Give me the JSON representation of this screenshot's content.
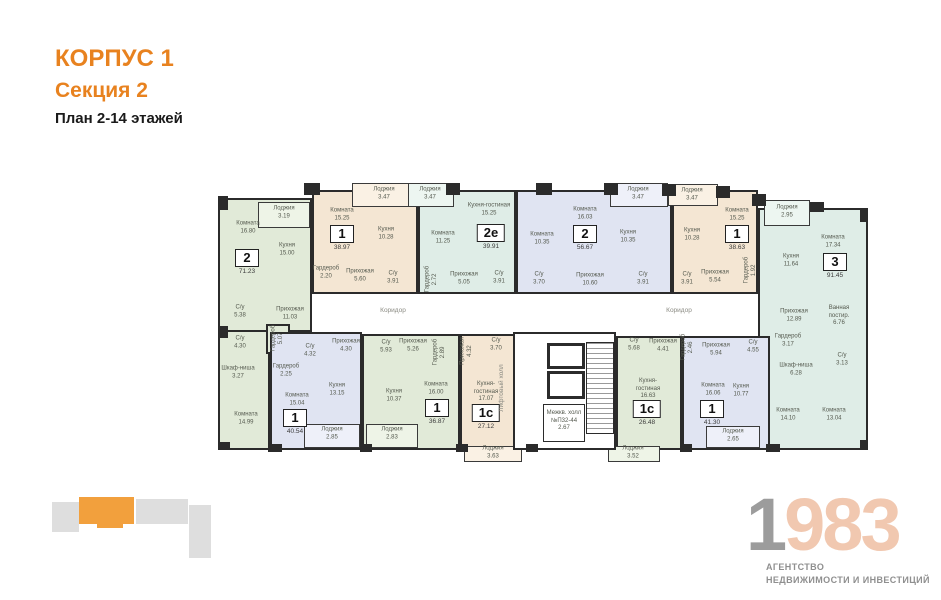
{
  "header": {
    "building": "КОРПУС 1",
    "section": "Секция 2",
    "plan": "План 2-14 этажей"
  },
  "palette": {
    "accent_orange": "#E8821F",
    "wall": "#2B2B2B",
    "apt_green": "#E1EAD8",
    "apt_beige": "#F4E6D3",
    "apt_mint": "#DFEDE7",
    "apt_blue": "#E0E4F2",
    "logo_gray": "#9C9C9C",
    "logo_peach": "#F1C8B0",
    "mini_gray": "#DEDEDE",
    "mini_orange": "#F2A03D"
  },
  "apartments": [
    {
      "badge": {
        "type": "2",
        "area": "71.23"
      },
      "rooms": [
        {
          "name": "Лоджия",
          "area": "3.19"
        },
        {
          "name": "Комната",
          "area": "16.80"
        },
        {
          "name": "Кухня",
          "area": "15.00"
        },
        {
          "name": "Прихожая",
          "area": "11.03"
        },
        {
          "name": "С/у",
          "area": "5.38"
        },
        {
          "name": "С/у",
          "area": "4.30"
        },
        {
          "name": "Гардероб",
          "area": "5.07"
        },
        {
          "name": "Шкаф-ниша",
          "area": "3.27"
        },
        {
          "name": "Комната",
          "area": "14.99"
        }
      ]
    },
    {
      "badge": {
        "type": "1",
        "area": "38.97"
      },
      "rooms": [
        {
          "name": "Лоджия",
          "area": "3.47"
        },
        {
          "name": "Комната",
          "area": "15.25"
        },
        {
          "name": "Кухня",
          "area": "10.28"
        },
        {
          "name": "Гардероб",
          "area": "2.20"
        },
        {
          "name": "Прихожая",
          "area": "5.60"
        },
        {
          "name": "С/у",
          "area": "3.91"
        }
      ]
    },
    {
      "badge": {
        "type": "2е",
        "area": "39.91"
      },
      "rooms": [
        {
          "name": "Лоджия",
          "area": "3.47"
        },
        {
          "name": "Кухня-гостиная",
          "area": "15.25"
        },
        {
          "name": "Комната",
          "area": "11.25"
        },
        {
          "name": "Гардероб",
          "area": "2.72"
        },
        {
          "name": "Прихожая",
          "area": "5.05"
        },
        {
          "name": "С/у",
          "area": "3.91"
        }
      ]
    },
    {
      "badge": {
        "type": "2",
        "area": "56.67"
      },
      "rooms": [
        {
          "name": "Лоджия",
          "area": "3.47"
        },
        {
          "name": "Комната",
          "area": "16.03"
        },
        {
          "name": "Комната",
          "area": "10.35"
        },
        {
          "name": "Кухня",
          "area": "10.35"
        },
        {
          "name": "Прихожая",
          "area": "10.60"
        },
        {
          "name": "С/у",
          "area": "3.70"
        },
        {
          "name": "С/у",
          "area": "3.91"
        }
      ]
    },
    {
      "badge": {
        "type": "1",
        "area": "38.63"
      },
      "rooms": [
        {
          "name": "Лоджия",
          "area": "3.47"
        },
        {
          "name": "Комната",
          "area": "15.25"
        },
        {
          "name": "Кухня",
          "area": "10.28"
        },
        {
          "name": "Прихожая",
          "area": "5.54"
        },
        {
          "name": "С/у",
          "area": "3.91"
        },
        {
          "name": "Гардероб",
          "area": "1.92"
        }
      ]
    },
    {
      "badge": {
        "type": "3",
        "area": "91.45"
      },
      "rooms": [
        {
          "name": "Лоджия",
          "area": "2.95"
        },
        {
          "name": "Комната",
          "area": "17.34"
        },
        {
          "name": "Кухня",
          "area": "11.64"
        },
        {
          "name": "Прихожая",
          "area": "12.89"
        },
        {
          "name": "Ванная постир.",
          "area": "6.76"
        },
        {
          "name": "Гардероб",
          "area": "3.17"
        },
        {
          "name": "Шкаф-ниша",
          "area": "6.28"
        },
        {
          "name": "С/у",
          "area": "3.13"
        },
        {
          "name": "Комната",
          "area": "14.10"
        },
        {
          "name": "Комната",
          "area": "13.04"
        }
      ]
    },
    {
      "badge": {
        "type": "1",
        "area": "40.54"
      },
      "rooms": [
        {
          "name": "Прихожая",
          "area": "4.30"
        },
        {
          "name": "С/у",
          "area": "4.32"
        },
        {
          "name": "Гардероб",
          "area": "2.25"
        },
        {
          "name": "Комната",
          "area": "15.04"
        },
        {
          "name": "Кухня",
          "area": "13.15"
        },
        {
          "name": "Лоджия",
          "area": "2.85"
        }
      ]
    },
    {
      "badge": {
        "type": "1",
        "area": "36.87"
      },
      "rooms": [
        {
          "name": "С/у",
          "area": "5.93"
        },
        {
          "name": "Прихожая",
          "area": "5.26"
        },
        {
          "name": "Гардероб",
          "area": "2.89"
        },
        {
          "name": "Кухня",
          "area": "10.37"
        },
        {
          "name": "Комната",
          "area": "16.00"
        },
        {
          "name": "Лоджия",
          "area": "2.83"
        }
      ]
    },
    {
      "badge": {
        "type": "1с",
        "area": "27.12"
      },
      "rooms": [
        {
          "name": "Прихожая",
          "area": "4.32"
        },
        {
          "name": "С/у",
          "area": "3.70"
        },
        {
          "name": "Кухня-гостиная",
          "area": "17.07"
        },
        {
          "name": "Лоджия",
          "area": "3.63"
        }
      ]
    },
    {
      "badge": {
        "type": "1с",
        "area": "26.48"
      },
      "rooms": [
        {
          "name": "С/у",
          "area": "5.68"
        },
        {
          "name": "Прихожая",
          "area": "4.41"
        },
        {
          "name": "Кухня-гостиная",
          "area": "16.63"
        },
        {
          "name": "Лоджия",
          "area": "3.52"
        }
      ]
    },
    {
      "badge": {
        "type": "1",
        "area": "41.30"
      },
      "rooms": [
        {
          "name": "Гардероб",
          "area": "2.46"
        },
        {
          "name": "Прихожая",
          "area": "5.94"
        },
        {
          "name": "С/у",
          "area": "4.55"
        },
        {
          "name": "Комната",
          "area": "16.06"
        },
        {
          "name": "Кухня",
          "area": "10.77"
        },
        {
          "name": "Лоджия",
          "area": "2.65"
        }
      ]
    }
  ],
  "core": {
    "corridor_left": "Коридор",
    "corridor_right": "Коридор",
    "lift_hall": "Лифтовый холл",
    "inter_hall_name": "Межкв. холл",
    "inter_hall_num": "№П32-44",
    "inter_hall_area": "2.67"
  },
  "logo": {
    "digit_first": "1",
    "digits_rest": "983",
    "caption1": "АГЕНТСТВО",
    "caption2": "НЕДВИЖИМОСТИ И ИНВЕСТИЦИЙ"
  }
}
